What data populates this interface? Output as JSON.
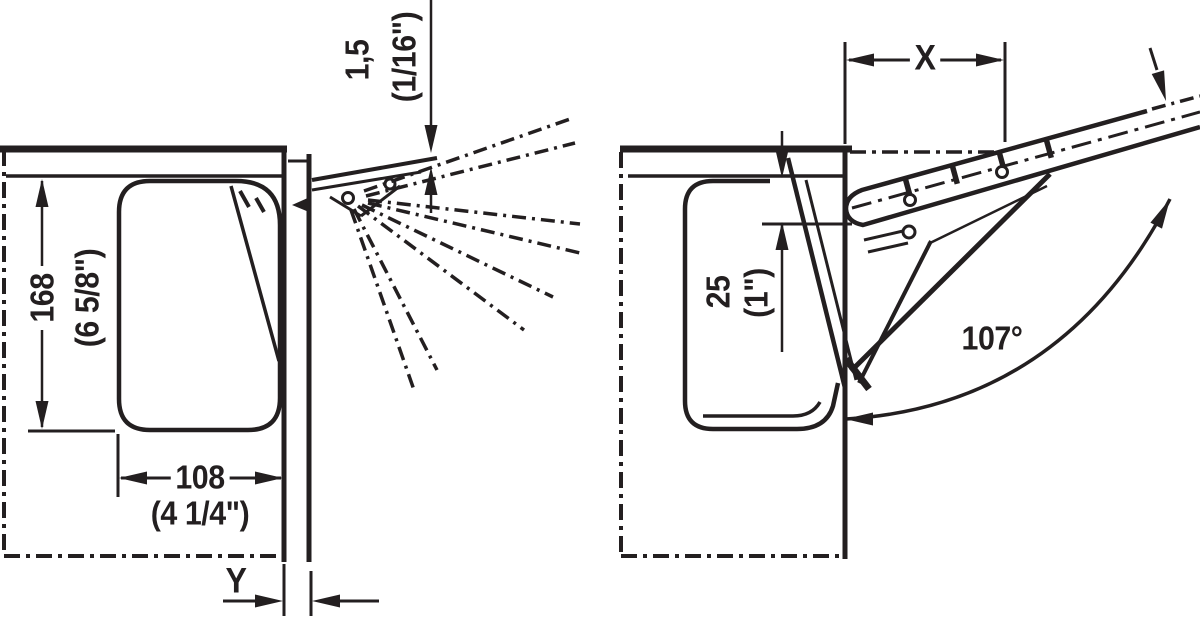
{
  "figure": {
    "type": "technical-installation-drawing",
    "ink_color": "#231f20",
    "background": "#ffffff",
    "views": [
      {
        "id": "closed",
        "description": "cabinet cross-section with flap closed, intermediate opening positions shown as phantom dash-dot lines"
      },
      {
        "id": "open",
        "description": "cabinet cross-section with flap fully open at maximum angle"
      }
    ]
  },
  "labels": {
    "offset_mm": "1,5",
    "offset_in": "(1/16\")",
    "height_mm": "168",
    "height_in": "(6 5/8\")",
    "depth_mm": "108",
    "depth_in": "(4 1/4\")",
    "gap_y": "Y",
    "dist_x": "X",
    "front_mm": "25",
    "front_in": "(1\")",
    "angle": "107°"
  }
}
